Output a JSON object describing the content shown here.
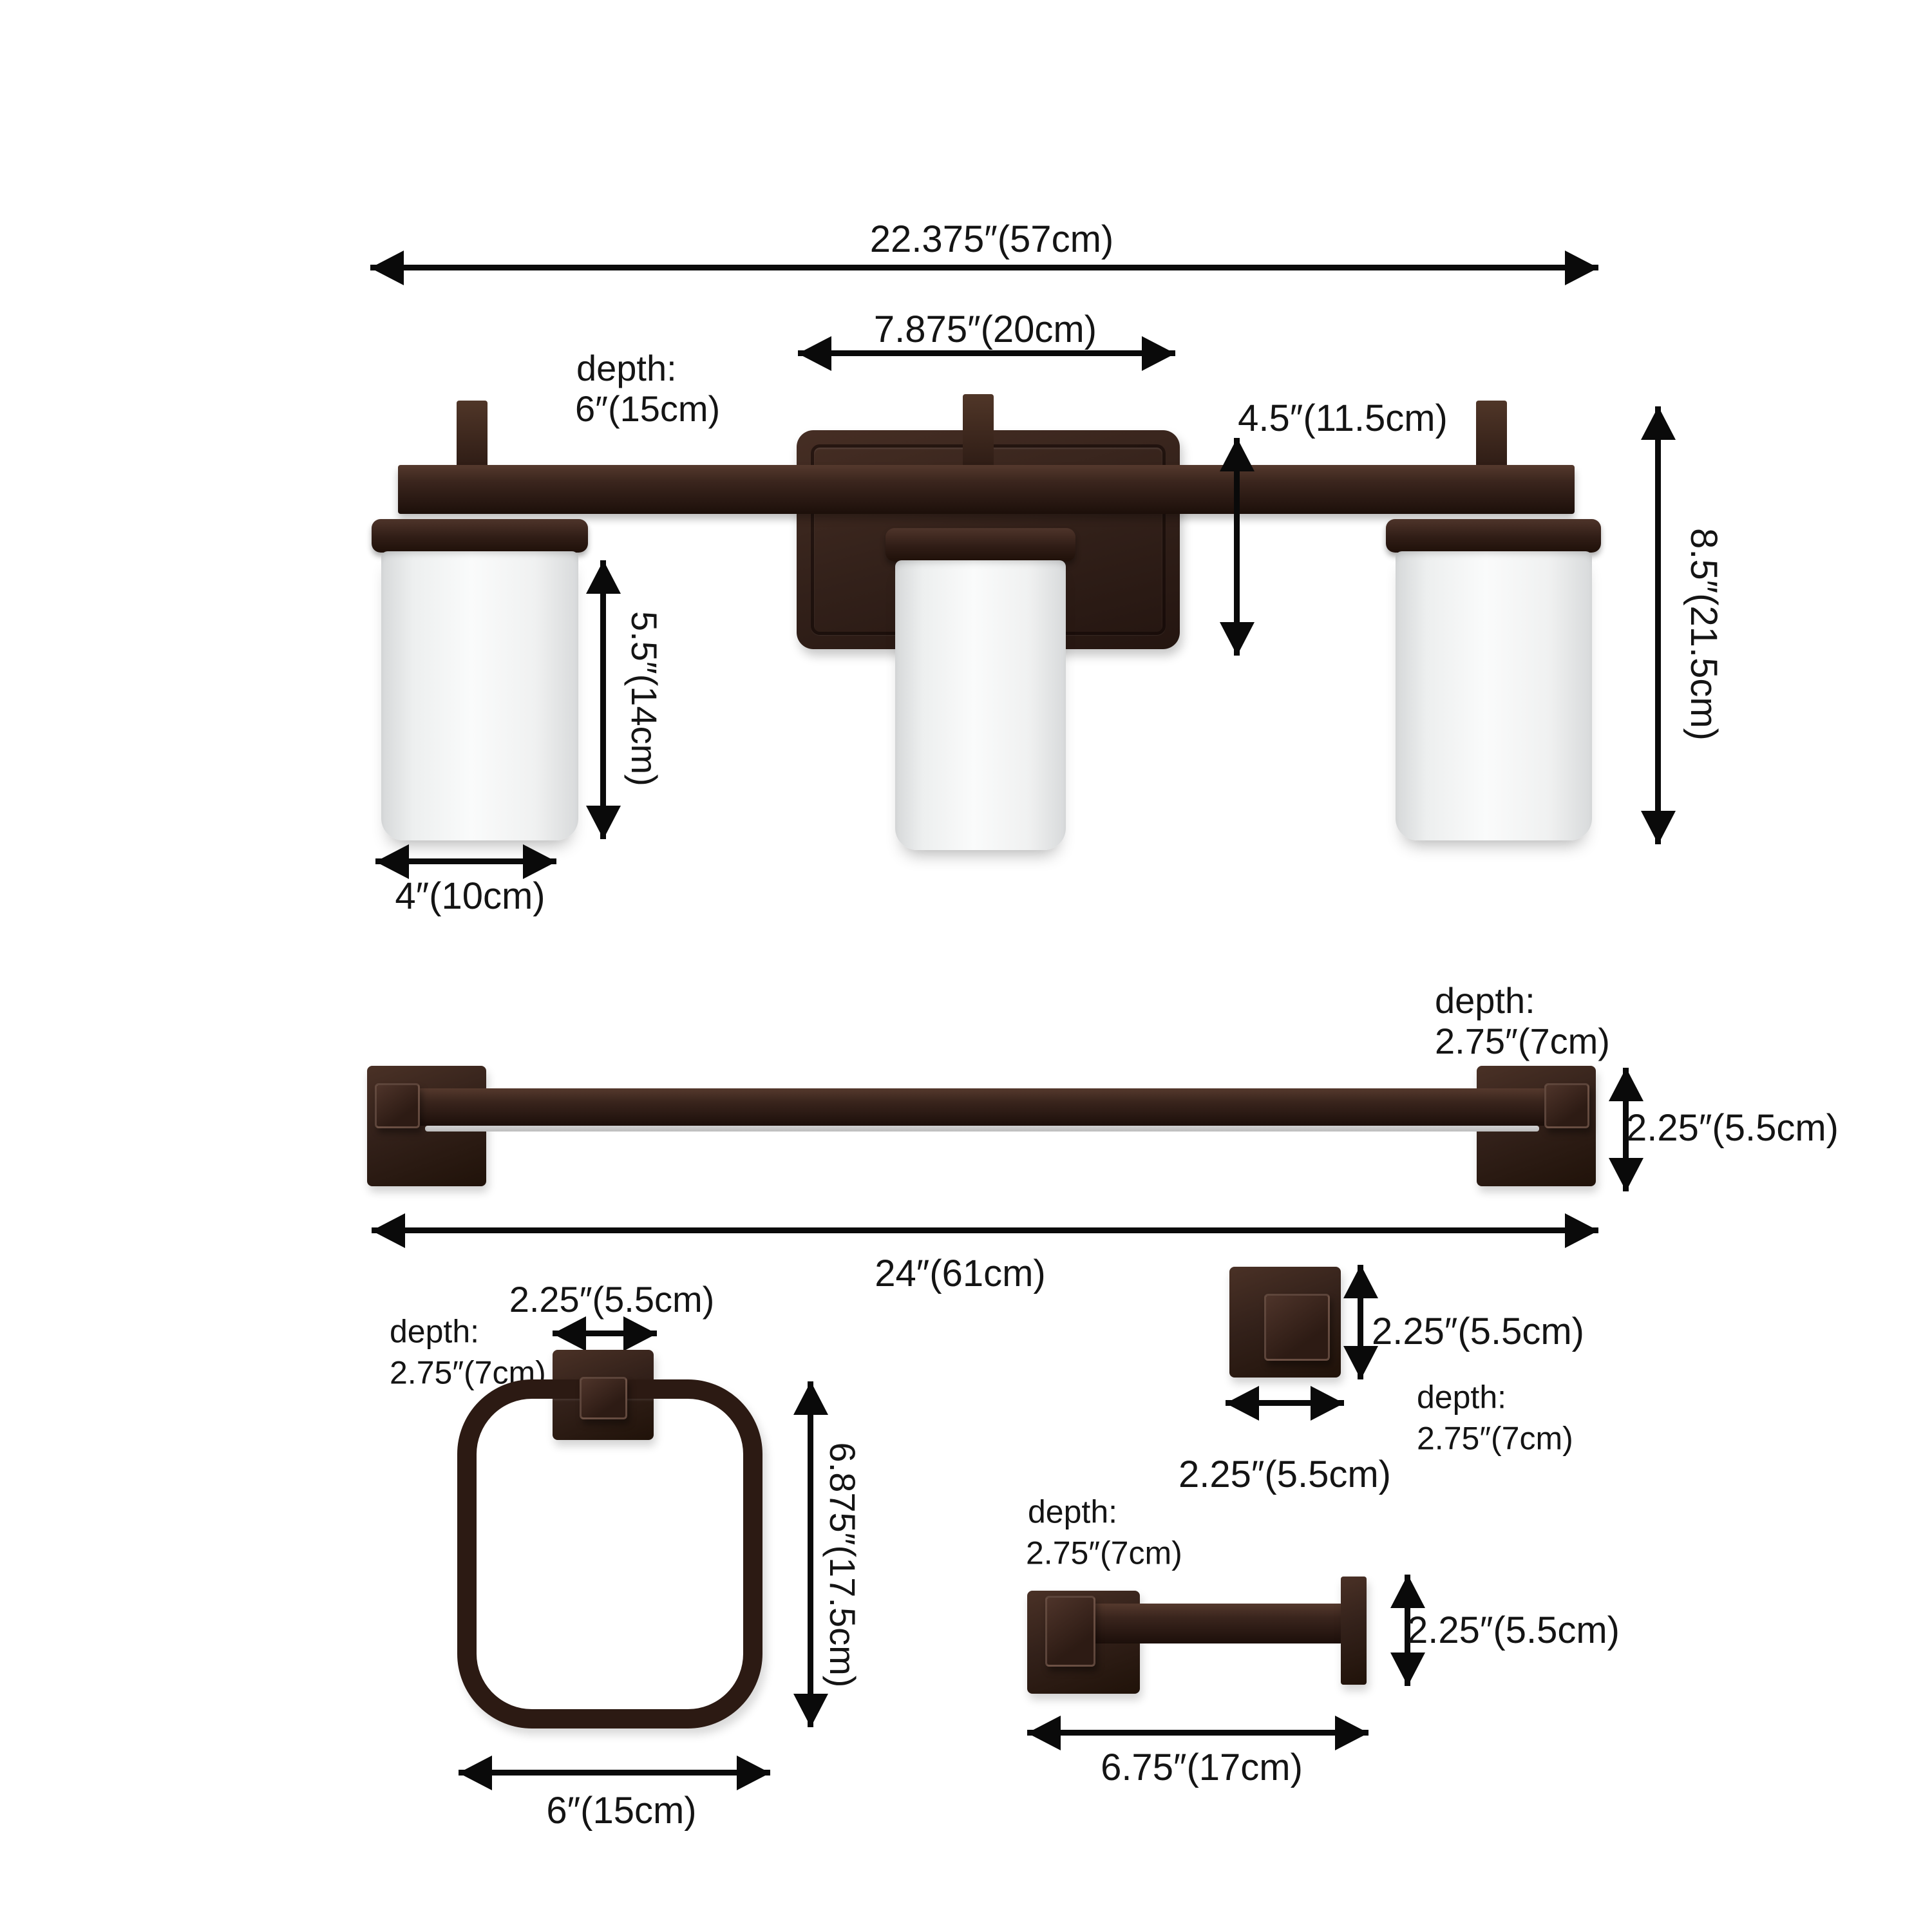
{
  "diagram_type": "bathroom-hardware-set-dimension-diagram",
  "colors": {
    "background": "#ffffff",
    "bronze": "#33211a",
    "bronze_highlight": "#55392d",
    "glass": "#f4f5f5",
    "arrow": "#0a0a0a",
    "text": "#141414"
  },
  "vanity_light": {
    "overall_width": "22.375″(57cm)",
    "backplate_width": "7.875″(20cm)",
    "depth_label": "depth:",
    "depth_value": "6″(15cm)",
    "backplate_height": "4.5″(11.5cm)",
    "total_height": "8.5″(21.5cm)",
    "shade_height": "5.5″(14cm)",
    "shade_width": "4″(10cm)"
  },
  "towel_bar": {
    "depth_label": "depth:",
    "depth_value": "2.75″(7cm)",
    "end_height": "2.25″(5.5cm)",
    "length": "24″(61cm)"
  },
  "towel_ring": {
    "plate_width": "2.25″(5.5cm)",
    "depth_label": "depth:",
    "depth_value": "2.75″(7cm)",
    "height": "6.875″(17.5cm)",
    "width": "6″(15cm)"
  },
  "robe_hook": {
    "height": "2.25″(5.5cm)",
    "depth_label": "depth:",
    "depth_value": "2.75″(7cm)",
    "width": "2.25″(5.5cm)"
  },
  "paper_holder": {
    "depth_label": "depth:",
    "depth_value": "2.75″(7cm)",
    "height": "2.25″(5.5cm)",
    "width": "6.75″(17cm)"
  }
}
